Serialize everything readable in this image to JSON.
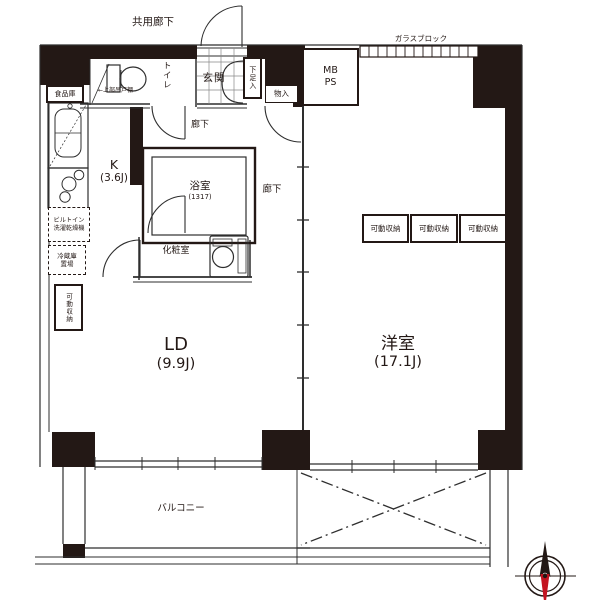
{
  "colors": {
    "wall": "#231815",
    "line": "#2e2e2e",
    "grid": "#888888",
    "compass_needle_red": "#c41421",
    "background": "#ffffff"
  },
  "header": {
    "common_corridor": "共用廊下",
    "glass_block": "ガラスブロック"
  },
  "rooms": {
    "entrance": "玄関",
    "toilet": "トイレ",
    "shoe_box": "下足入",
    "closet": "物入",
    "mb": "MB",
    "ps": "PS",
    "pantry": "食品庫",
    "upper_cabinet": "←上部吊戸棚",
    "kitchen": {
      "name": "K",
      "size": "(3.6J)"
    },
    "hallway_upper": "廊下",
    "hallway_lower": "廊下",
    "bathroom": {
      "name": "浴室",
      "size": "(1317)"
    },
    "powder_room": "化粧室",
    "washer": {
      "line1": "ビルトイン",
      "line2": "洗濯乾燥機"
    },
    "fridge": {
      "line1": "冷蔵庫",
      "line2": "置場"
    },
    "storage_side": "可動収納",
    "storage_1": "可動収納",
    "storage_2": "可動収納",
    "storage_3": "可動収納",
    "living": {
      "name": "LD",
      "size": "(9.9J)"
    },
    "western": {
      "name": "洋室",
      "size": "(17.1J)"
    },
    "balcony": "バルコニー"
  }
}
